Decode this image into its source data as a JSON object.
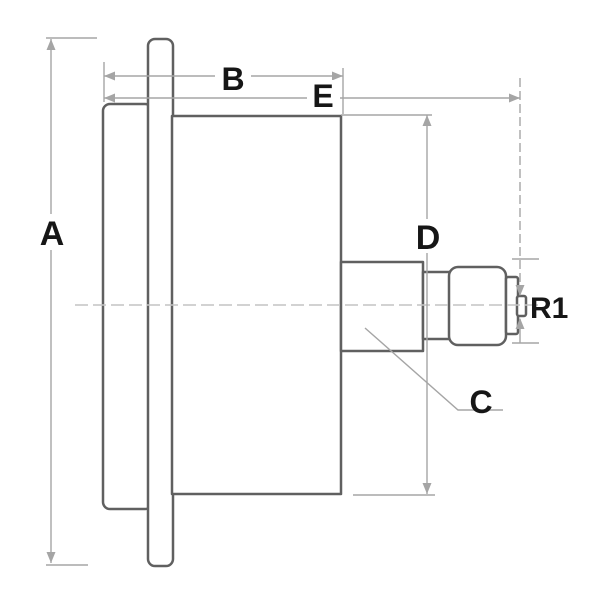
{
  "diagram": {
    "kind": "technical-dimension-drawing",
    "labels": {
      "overall_height": "A",
      "case_depth": "B",
      "connection": "C",
      "case_diameter": "D",
      "overall_depth": "E",
      "thread_size": "R1"
    },
    "colors": {
      "outline": "#606060",
      "dimension": "#a5a5a5",
      "centerline": "#c4c4c4",
      "label": "#161616",
      "background": "#ffffff"
    }
  }
}
